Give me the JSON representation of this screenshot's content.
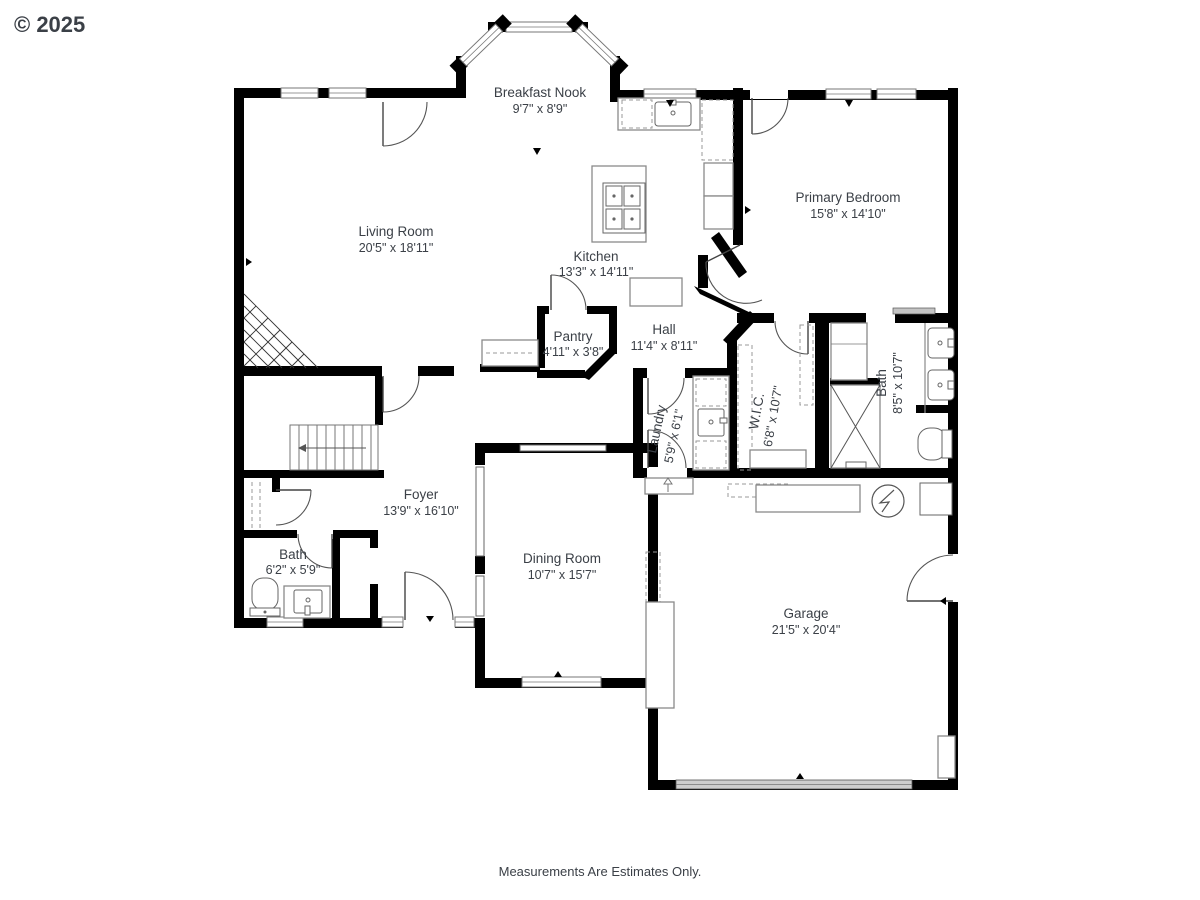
{
  "watermark": "© 2025",
  "footer": "Measurements Are Estimates Only.",
  "colors": {
    "walls": "#000000",
    "fixtures": "#8a8a8a",
    "text": "#3b4047",
    "watermark": "#d2d2d2",
    "garage_door": "#cfcfcf"
  },
  "rooms": [
    {
      "name": "Breakfast Nook",
      "dims": "9'7\" x 8'9\""
    },
    {
      "name": "Living Room",
      "dims": "20'5\" x 18'11\""
    },
    {
      "name": "Primary Bedroom",
      "dims": "15'8\" x 14'10\""
    },
    {
      "name": "Kitchen",
      "dims": "13'3\" x 14'11\""
    },
    {
      "name": "Pantry",
      "dims": "4'11\" x 3'8\""
    },
    {
      "name": "Hall",
      "dims": "11'4\" x 8'11\""
    },
    {
      "name": "Laundry",
      "dims": "5'9\" x 6'1\""
    },
    {
      "name": "W.I.C.",
      "dims": "6'8\" x 10'7\""
    },
    {
      "name": "Bath",
      "dims": "8'5\" x 10'7\""
    },
    {
      "name": "Foyer",
      "dims": "13'9\" x 16'10\""
    },
    {
      "name": "Bath",
      "dims": "6'2\" x 5'9\""
    },
    {
      "name": "Dining Room",
      "dims": "10'7\" x 15'7\""
    },
    {
      "name": "Garage",
      "dims": "21'5\" x 20'4\""
    }
  ]
}
